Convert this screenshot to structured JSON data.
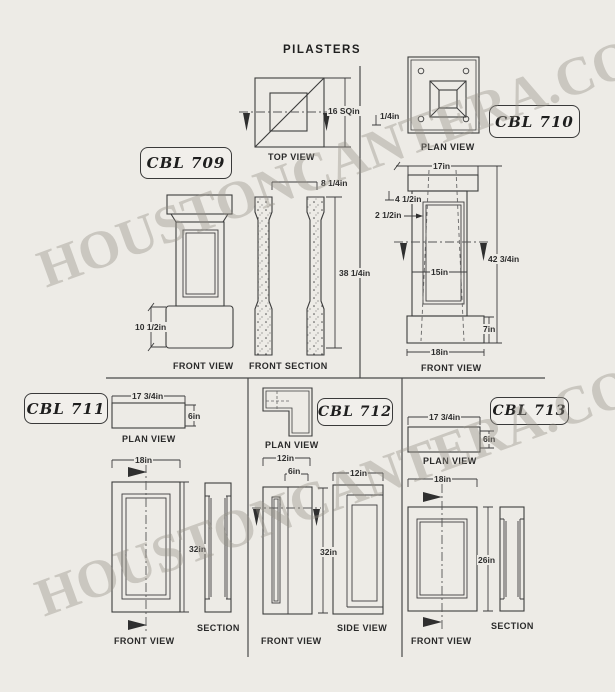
{
  "page": {
    "title": "PILASTERS",
    "watermark": "HOUSTONCANTERA.COM"
  },
  "cbl709": {
    "label": "CBL 709",
    "top_view": {
      "label": "TOP VIEW",
      "dim_area": "16 SQin"
    },
    "front_view": {
      "label": "FRONT VIEW",
      "dim_base_height": "10 1/2in"
    },
    "front_section": {
      "label": "FRONT SECTION",
      "dim_width": "8 1/4in",
      "dim_height": "38 1/4in"
    }
  },
  "cbl710": {
    "label": "CBL 710",
    "plan_view": {
      "label": "PLAN VIEW",
      "dim_edge": "1/4in"
    },
    "front_view": {
      "label": "FRONT VIEW",
      "dim_top_width": "17in",
      "dim_cap_height": "4 1/2in",
      "dim_wall": "2 1/2in",
      "dim_overall_height": "42 3/4in",
      "dim_panel_width": "15in",
      "dim_base_height": "7in",
      "dim_base_width": "18in"
    }
  },
  "cbl711": {
    "label": "CBL 711",
    "plan_view": {
      "label": "PLAN VIEW",
      "dim_width": "17 3/4in",
      "dim_depth": "6in"
    },
    "front_view": {
      "label": "FRONT VIEW",
      "dim_width": "18in",
      "dim_height": "32in"
    },
    "section": {
      "label": "SECTION"
    }
  },
  "cbl712": {
    "label": "CBL 712",
    "plan_view": {
      "label": "PLAN VIEW"
    },
    "front_view": {
      "label": "FRONT VIEW",
      "dim_width": "12in",
      "dim_face": "6in",
      "dim_height": "32in"
    },
    "side_view": {
      "label": "SIDE VIEW",
      "dim_width": "12in"
    }
  },
  "cbl713": {
    "label": "CBL 713",
    "plan_view": {
      "label": "PLAN VIEW",
      "dim_width": "17 3/4in",
      "dim_depth": "6in"
    },
    "front_view": {
      "label": "FRONT VIEW",
      "dim_width": "18in",
      "dim_height": "26in"
    },
    "section": {
      "label": "SECTION"
    }
  },
  "colors": {
    "background": "#edebe6",
    "line": "#3d3d3d",
    "watermark": "#979288"
  }
}
